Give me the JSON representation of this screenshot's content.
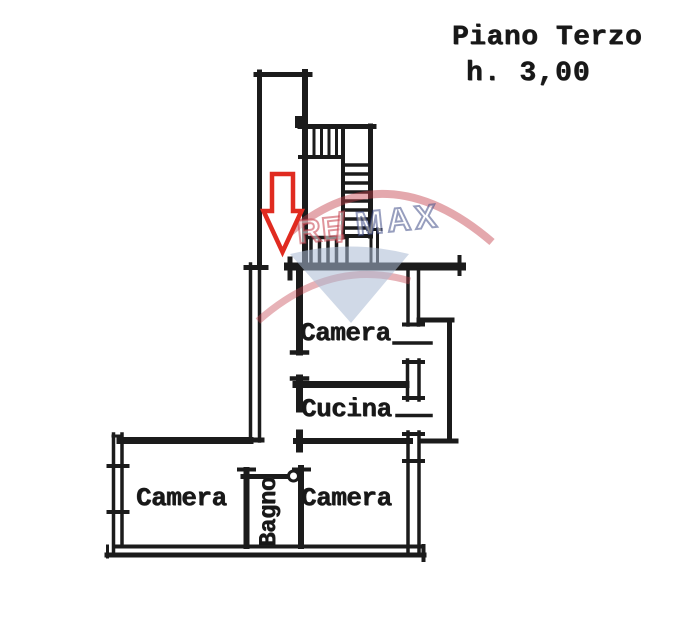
{
  "header": {
    "title": "Piano Terzo",
    "height_note": "h. 3,00"
  },
  "rooms": {
    "camera_middle": "Camera",
    "cucina": "Cucina",
    "camera_bottom_left": "Camera",
    "camera_bottom_right": "Camera",
    "bagno": "Bagno"
  },
  "watermark": {
    "re": "RE",
    "slash": "/",
    "max": "MAX",
    "red": "#c43e4a",
    "blue": "#2f3e7d",
    "shield_fill": "#aab9d4"
  },
  "annotations": {
    "arrow_direction": "down",
    "arrow_color": "#e02b20"
  },
  "ink_color": "#1b1b1b"
}
